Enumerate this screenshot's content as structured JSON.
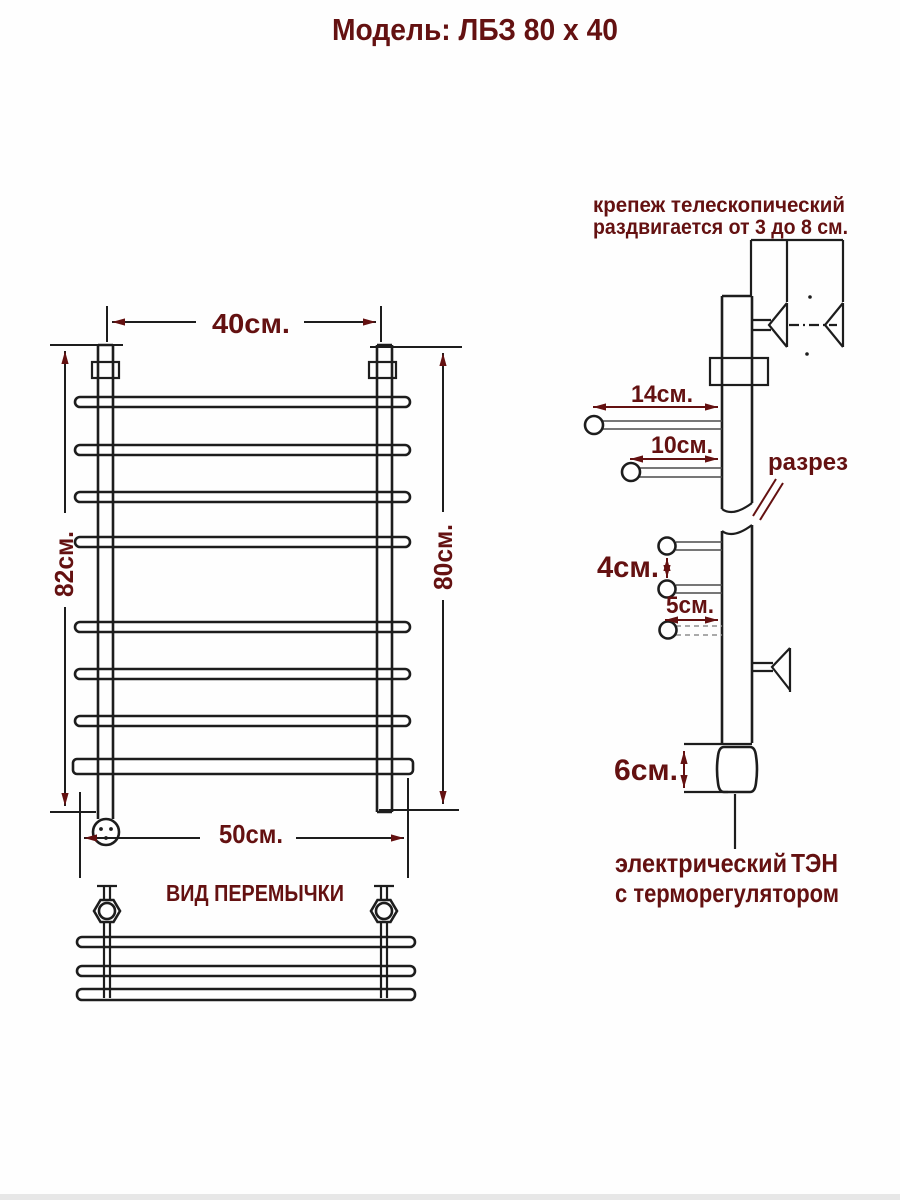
{
  "title": "Модель: ЛБЗ 80 х 40",
  "colors": {
    "line": "#1d1d1d",
    "label": "#641111",
    "background": "#ffffff"
  },
  "front_view": {
    "width_top": "40см.",
    "height_left": "82см.",
    "height_right": "80см.",
    "width_bottom": "50см."
  },
  "crossbar_view": {
    "title": "ВИД ПЕРЕМЫЧКИ"
  },
  "side_view": {
    "mount_note_line1": "крепеж телескопический",
    "mount_note_line2": "раздвигается от 3 до 8 см.",
    "offset_top": "14см.",
    "offset_mid": "10см.",
    "section_label": "разрез",
    "rung_gap": "4см.",
    "rung_offset": "5см.",
    "heater_height": "6см.",
    "heater_label_1a": "электрический",
    "heater_label_1b": "ТЭН",
    "heater_label_2": "с терморегулятором"
  }
}
